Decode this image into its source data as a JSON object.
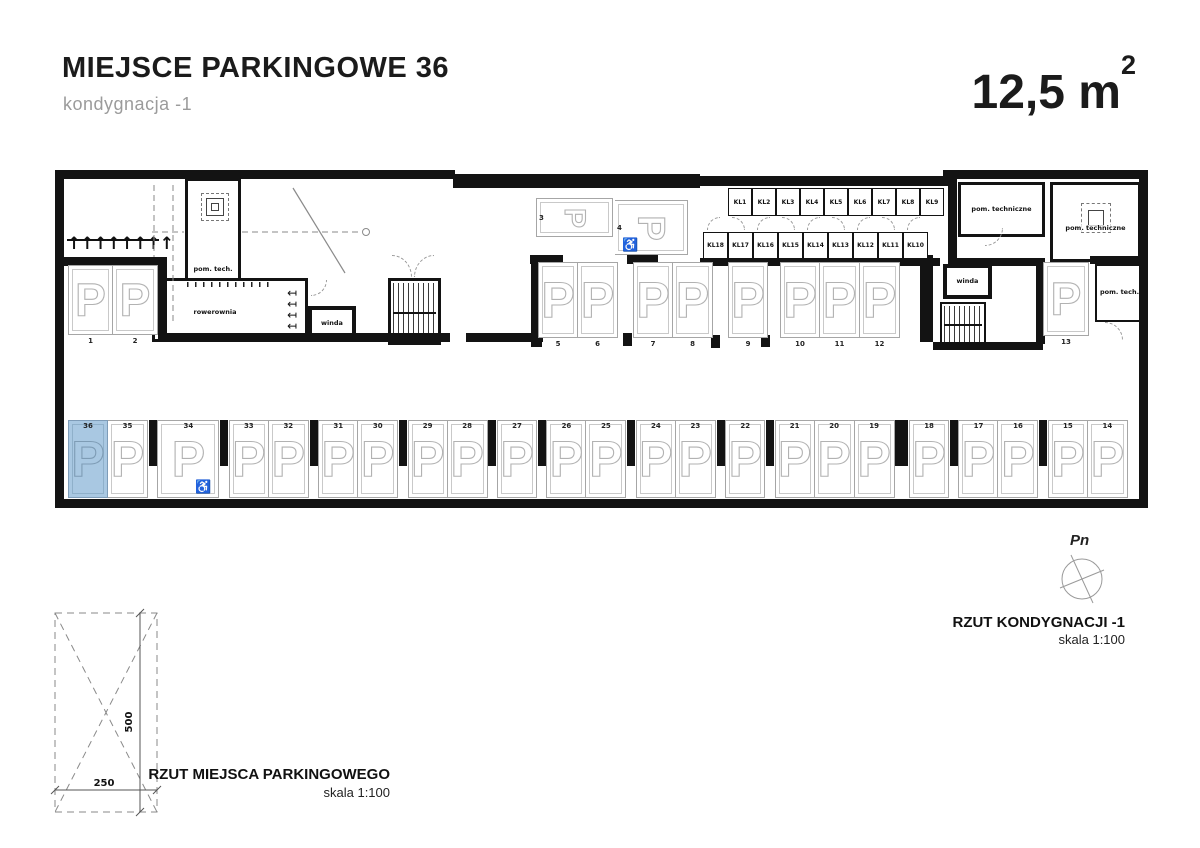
{
  "header": {
    "title": "MIEJSCE PARKINGOWE 36",
    "subtitle": "kondygnacja -1",
    "area": "12,5 m",
    "area_sup": "2"
  },
  "plan": {
    "labels": {
      "pom_tech_left": "pom. tech.",
      "rowerownia": "rowerownia",
      "winda_left": "winda",
      "winda_right": "winda",
      "pom_techniczne_a": "pom. techniczne",
      "pom_techniczne_b": "pom. techniczne",
      "pom_tech_right": "pom. tech."
    },
    "lockers_top": [
      "KL1",
      "KL2",
      "KL3",
      "KL4",
      "KL5",
      "KL6",
      "KL7",
      "KL8",
      "KL9"
    ],
    "lockers_bottom": [
      "KL18",
      "KL17",
      "KL16",
      "KL15",
      "KL14",
      "KL13",
      "KL12",
      "KL11",
      "KL10"
    ],
    "parking_left": [
      "1",
      "2"
    ],
    "parking_horizontal": [
      {
        "number": "3",
        "disabled": false
      },
      {
        "number": "4",
        "disabled": true
      }
    ],
    "parking_middle_groups": [
      [
        "5",
        "6"
      ],
      [
        "7",
        "8"
      ],
      [
        "9"
      ],
      [
        "10",
        "11",
        "12"
      ]
    ],
    "parking_13": "13",
    "parking_bottom_groups": [
      [
        "36",
        "35"
      ],
      [
        "34"
      ],
      [
        "33",
        "32"
      ],
      [
        "31",
        "30"
      ],
      [
        "29",
        "28"
      ],
      [
        "27"
      ],
      [
        "26",
        "25"
      ],
      [
        "24",
        "23"
      ],
      [
        "22"
      ],
      [
        "21",
        "20",
        "19"
      ],
      [
        "18"
      ],
      [
        "17",
        "16"
      ],
      [
        "15",
        "14"
      ]
    ],
    "highlighted_space": "36",
    "disabled_bottom_space": "34",
    "highlight_color": "#a9c8e2"
  },
  "compass_label": "Pn",
  "site_plan_caption": {
    "line1": "RZUT KONDYGNACJI -1",
    "line2": "skala 1:100"
  },
  "detail": {
    "width_dim": "250",
    "height_dim": "500",
    "line1": "RZUT MIEJSCA PARKINGOWEGO",
    "line2": "skala 1:100"
  }
}
